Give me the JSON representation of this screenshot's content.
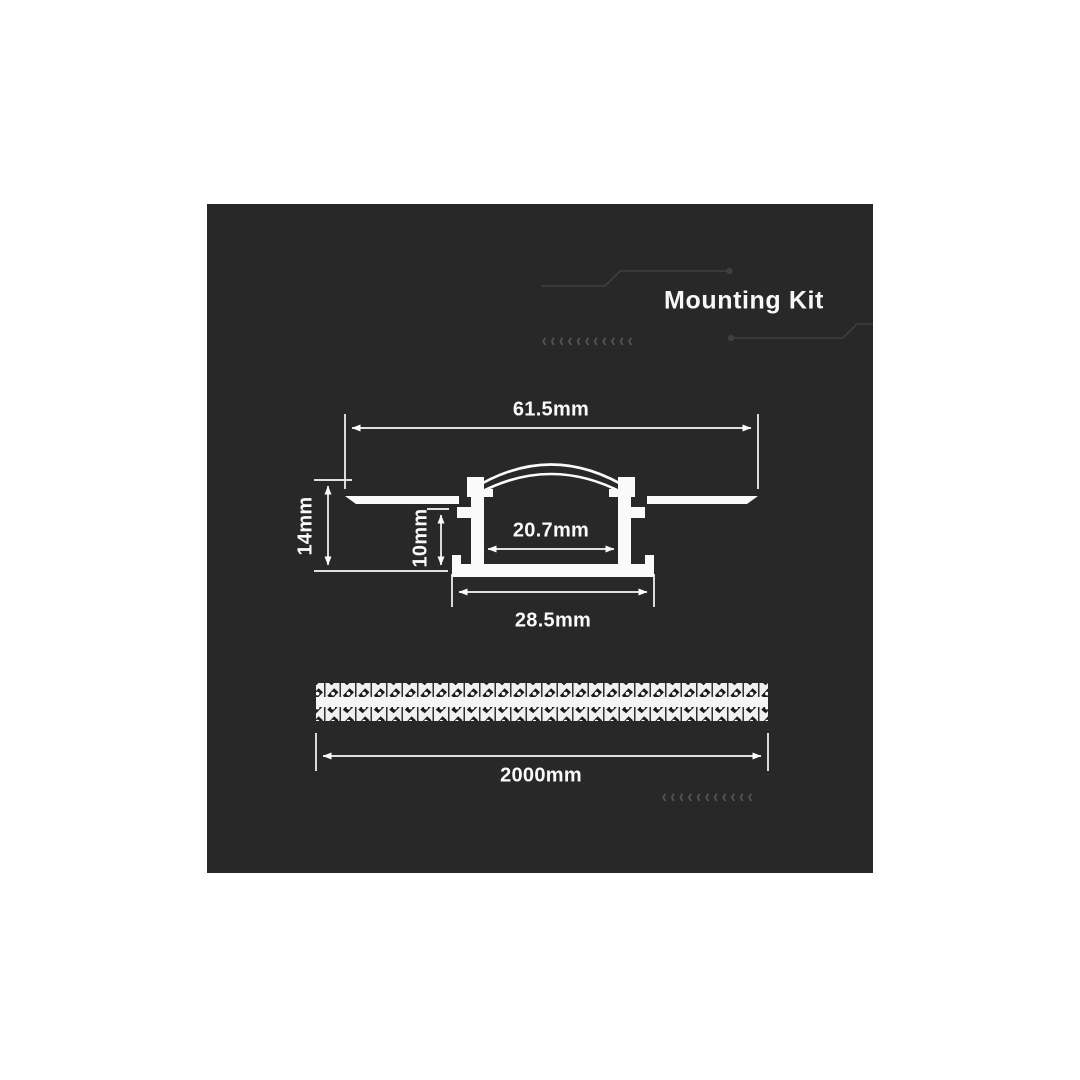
{
  "header": {
    "title": "Mounting Kit"
  },
  "diagram": {
    "profile_dimensions": {
      "overall_width": "61.5mm",
      "overall_height": "14mm",
      "inner_height": "10mm",
      "inner_width": "20.7mm",
      "base_width": "28.5mm"
    },
    "strip": {
      "length": "2000mm"
    }
  },
  "decorations": {
    "chevron_char": "‹",
    "chevron_count": 11
  },
  "colors": {
    "panel_background": "#282828",
    "page_background": "#ffffff",
    "drawing_line": "#fafafa",
    "circuit_trace": "#3f3f41",
    "chevron": "#565656",
    "strip_pattern_dark": "#1c1c1c",
    "strip_pattern_light": "#f0f0f0"
  }
}
